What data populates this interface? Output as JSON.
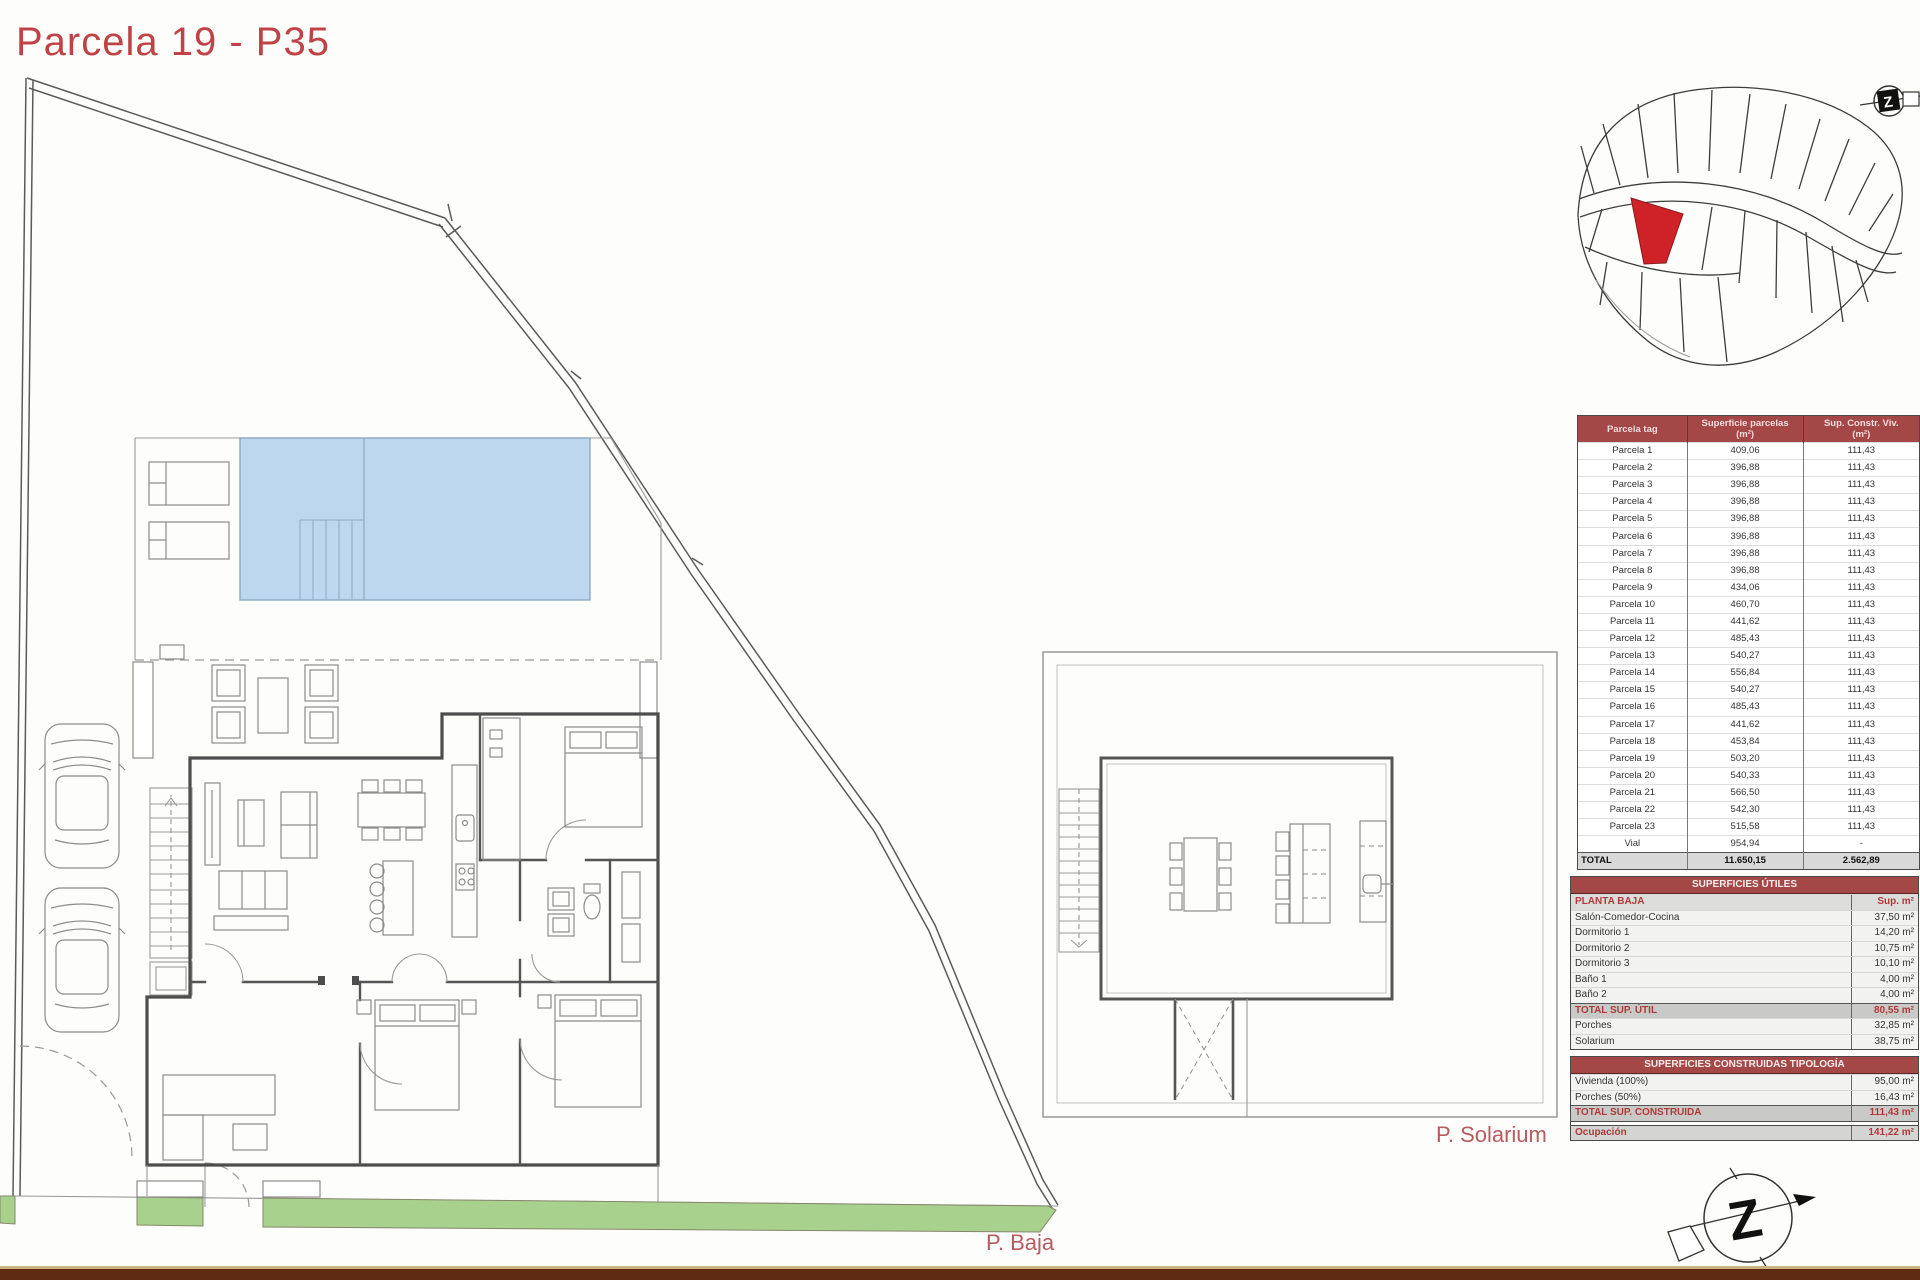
{
  "title": "Parcela 19 - P35",
  "labels": {
    "planta_baja": "P. Baja",
    "planta_solarium": "P. Solarium"
  },
  "colors": {
    "accent_red": "#bf4346",
    "table_header_bg": "#a34747",
    "table_red_text": "#b03a3a",
    "pool_fill": "#bdd7ee",
    "green_strip": "#a9d18e",
    "highlight_parcel_red": "#cf2128",
    "bottom_bar_brown": "#5e2c12",
    "bottom_bar_tan": "#c9b37e"
  },
  "tables": {
    "parcelas": {
      "headers": {
        "col1": {
          "main": "Parcela tag",
          "sub": ""
        },
        "col2": {
          "main": "Superficie parcelas",
          "sub": "(m²)"
        },
        "col3": {
          "main": "Sup. Constr. Viv.",
          "sub": "(m²)"
        }
      },
      "rows": [
        {
          "tag": "Parcela 1",
          "superficie": "409,06",
          "constr": "111,43"
        },
        {
          "tag": "Parcela 2",
          "superficie": "396,88",
          "constr": "111,43"
        },
        {
          "tag": "Parcela 3",
          "superficie": "396,88",
          "constr": "111,43"
        },
        {
          "tag": "Parcela 4",
          "superficie": "396,88",
          "constr": "111,43"
        },
        {
          "tag": "Parcela 5",
          "superficie": "396,88",
          "constr": "111,43"
        },
        {
          "tag": "Parcela 6",
          "superficie": "396,88",
          "constr": "111,43"
        },
        {
          "tag": "Parcela 7",
          "superficie": "396,88",
          "constr": "111,43"
        },
        {
          "tag": "Parcela 8",
          "superficie": "396,88",
          "constr": "111,43"
        },
        {
          "tag": "Parcela 9",
          "superficie": "434,06",
          "constr": "111,43"
        },
        {
          "tag": "Parcela 10",
          "superficie": "460,70",
          "constr": "111,43"
        },
        {
          "tag": "Parcela 11",
          "superficie": "441,62",
          "constr": "111,43"
        },
        {
          "tag": "Parcela 12",
          "superficie": "485,43",
          "constr": "111,43"
        },
        {
          "tag": "Parcela 13",
          "superficie": "540,27",
          "constr": "111,43"
        },
        {
          "tag": "Parcela 14",
          "superficie": "556,84",
          "constr": "111,43"
        },
        {
          "tag": "Parcela 15",
          "superficie": "540,27",
          "constr": "111,43"
        },
        {
          "tag": "Parcela 16",
          "superficie": "485,43",
          "constr": "111,43"
        },
        {
          "tag": "Parcela 17",
          "superficie": "441,62",
          "constr": "111,43"
        },
        {
          "tag": "Parcela 18",
          "superficie": "453,84",
          "constr": "111,43"
        },
        {
          "tag": "Parcela 19",
          "superficie": "503,20",
          "constr": "111,43"
        },
        {
          "tag": "Parcela 20",
          "superficie": "540,33",
          "constr": "111,43"
        },
        {
          "tag": "Parcela 21",
          "superficie": "566,50",
          "constr": "111,43"
        },
        {
          "tag": "Parcela 22",
          "superficie": "542,30",
          "constr": "111,43"
        },
        {
          "tag": "Parcela 23",
          "superficie": "515,58",
          "constr": "111,43"
        },
        {
          "tag": "Vial",
          "superficie": "954,94",
          "constr": "-"
        }
      ],
      "total": {
        "tag": "TOTAL",
        "superficie": "11.650,15",
        "constr": "2.562,89"
      }
    },
    "superficies_utiles": {
      "title": "SUPERFICIES ÚTILES",
      "subheader": {
        "left": "PLANTA BAJA",
        "right": "Sup. m²"
      },
      "rows": [
        [
          "Salón-Comedor-Cocina",
          "37,50 m²"
        ],
        [
          "Dormitorio 1",
          "14,20 m²"
        ],
        [
          "Dormitorio 2",
          "10,75 m²"
        ],
        [
          "Dormitorio 3",
          "10,10 m²"
        ],
        [
          "Baño 1",
          "4,00 m²"
        ],
        [
          "Baño 2",
          "4,00 m²"
        ]
      ],
      "total": {
        "left": "TOTAL SUP. ÚTIL",
        "right": "80,55 m²"
      },
      "extra_rows": [
        [
          "Porches",
          "32,85 m²"
        ],
        [
          "Solarium",
          "38,75 m²"
        ]
      ]
    },
    "superficies_construidas": {
      "title": "SUPERFICIES CONSTRUIDAS TIPOLOGÍA",
      "rows": [
        [
          "Vivienda (100%)",
          "95,00 m²"
        ],
        [
          "Porches (50%)",
          "16,43 m²"
        ]
      ],
      "total": {
        "left": "TOTAL SUP. CONSTRUIDA",
        "right": "111,43 m²"
      },
      "ocupacion": {
        "left": "Ocupación",
        "right": "141,22 m²"
      }
    }
  }
}
